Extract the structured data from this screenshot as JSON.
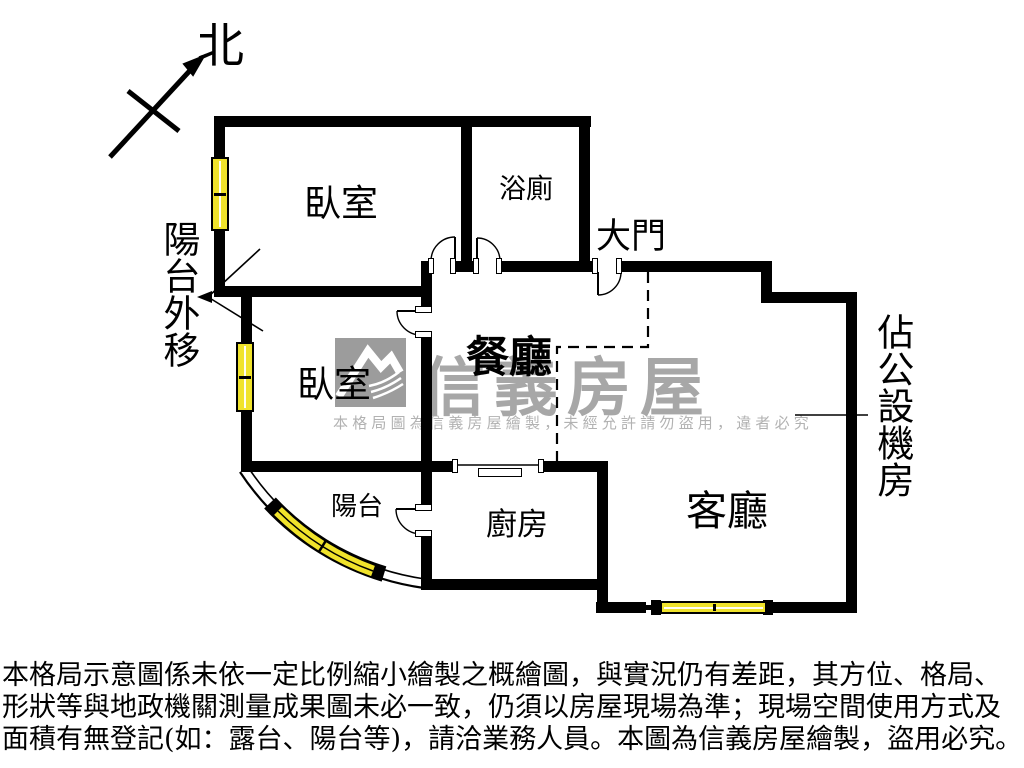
{
  "compass": {
    "label": "北"
  },
  "floorplan": {
    "rooms": [
      {
        "id": "bedroom-1",
        "label": "臥室"
      },
      {
        "id": "bathroom",
        "label": "浴廁"
      },
      {
        "id": "bedroom-2",
        "label": "臥室"
      },
      {
        "id": "dining-room",
        "label": "餐廳"
      },
      {
        "id": "living-room",
        "label": "客廳"
      },
      {
        "id": "kitchen",
        "label": "廚房"
      },
      {
        "id": "balcony",
        "label": "陽台"
      }
    ],
    "annotations": [
      {
        "id": "main-door",
        "label": "大門"
      },
      {
        "id": "balcony-relocated",
        "label": "陽台外移"
      },
      {
        "id": "public-facility-room",
        "label": "佔公設機房"
      }
    ]
  },
  "watermark": {
    "brand": "信義房屋",
    "notice": "本格局圖為信義房屋繪製，未經允許請勿盜用，違者必究"
  },
  "disclaimer": {
    "line1": "本格局示意圖係未依一定比例縮小繪製之概繪圖，與實況仍有差距，其方位、格局、",
    "line2": "形狀等與地政機關測量成果圖未必一致，仍須以房屋現場為準；現場空間使用方式及",
    "line3": "面積有無登記(如：露台、陽台等)，請洽業務人員。本圖為信義房屋繪製，盜用必究。"
  },
  "colors": {
    "wall": "#000000",
    "window_yellow": "#F0E32B",
    "watermark_gray": "#A7A7A7",
    "logo_gray": "#9C9C9C"
  }
}
